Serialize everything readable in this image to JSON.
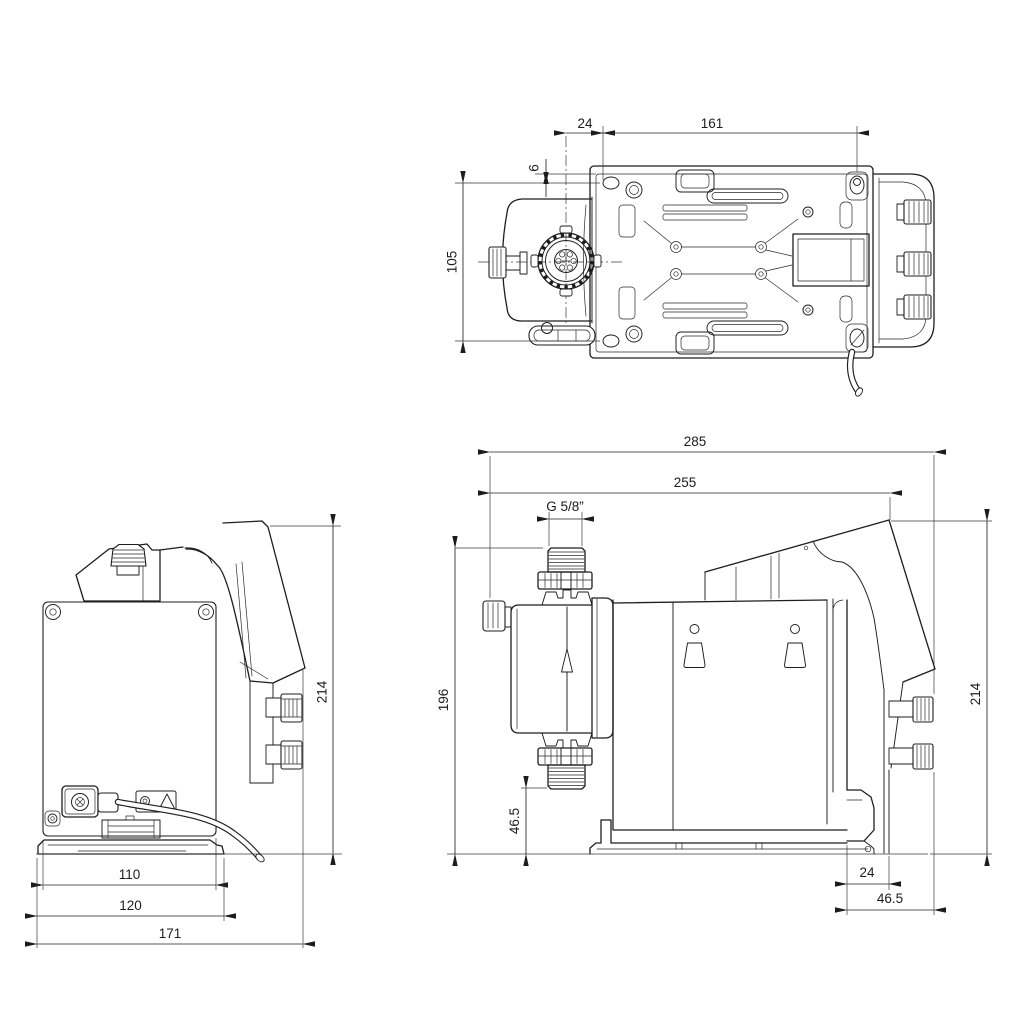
{
  "drawing_meta": {
    "kind": "technical-dimensional-drawing",
    "views": [
      "top-view",
      "rear-view",
      "side-view"
    ],
    "colors": {
      "line": "#1e1e20",
      "background": "#ffffff",
      "dimension_text": "#1c1c1e"
    }
  },
  "dims": {
    "top": {
      "d24": "24",
      "d161": "161",
      "d6": "6",
      "d105": "105"
    },
    "rear": {
      "d214": "214",
      "d110": "110",
      "d120": "120",
      "d171": "171"
    },
    "side": {
      "d285": "285",
      "d255": "255",
      "thread": "G 5/8”",
      "d196": "196",
      "d46_5_suction": "46.5",
      "d214": "214",
      "d24_bracket": "24",
      "d46_5_bracket": "46.5"
    }
  }
}
